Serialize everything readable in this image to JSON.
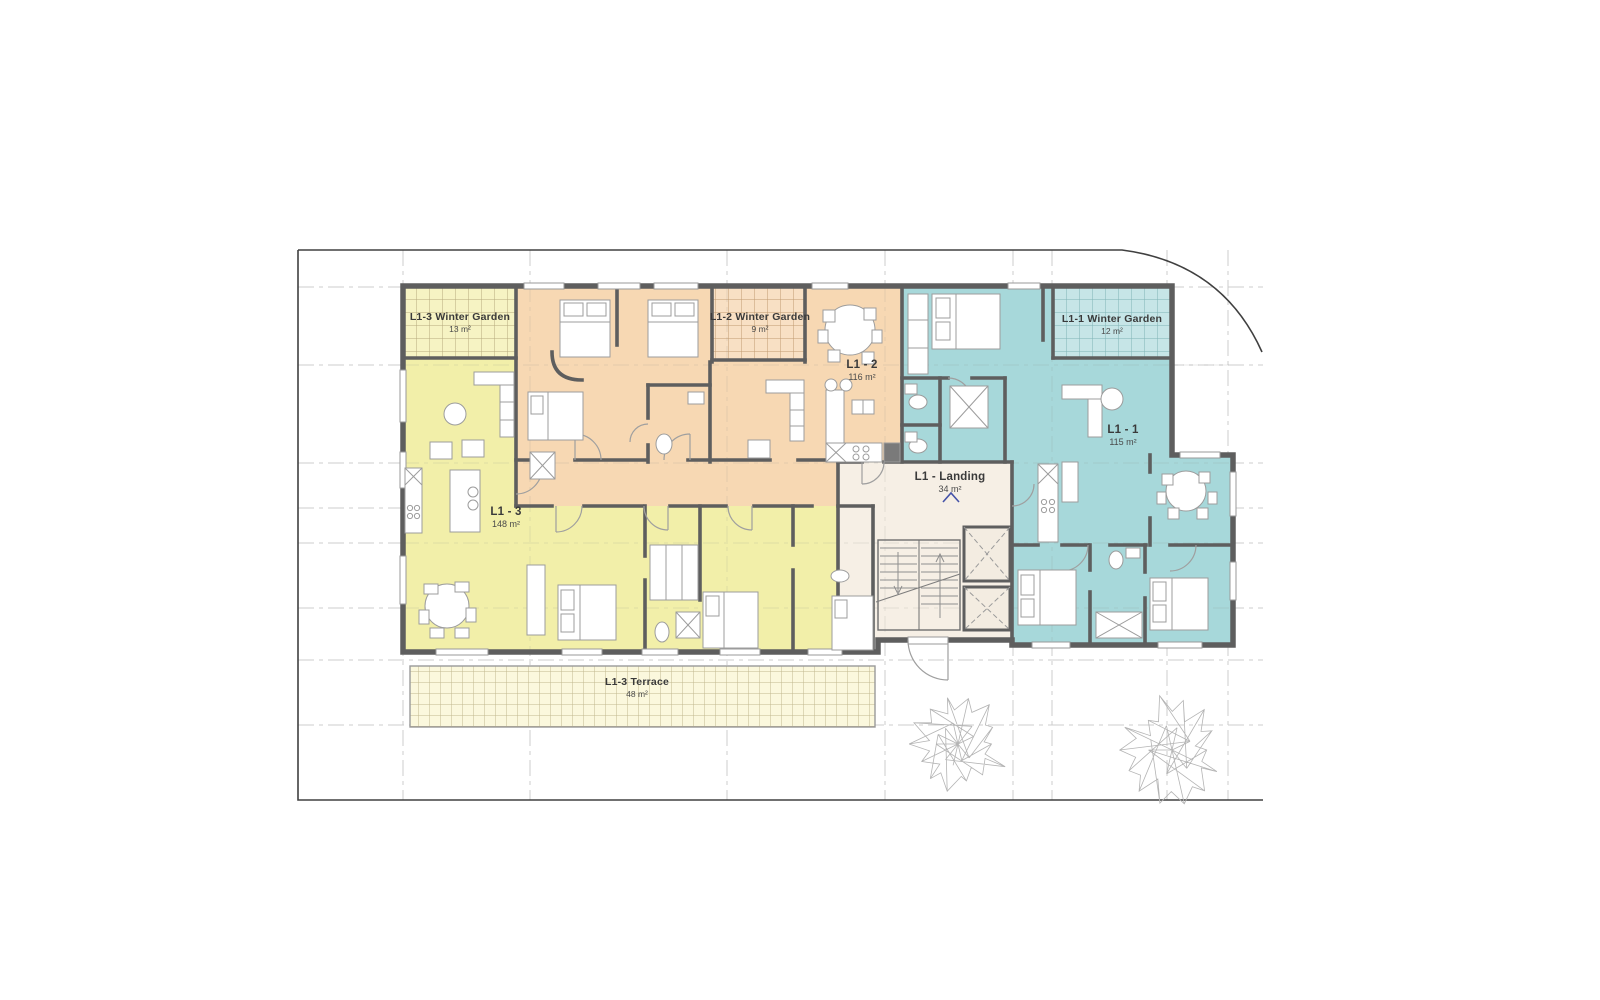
{
  "plan": {
    "units": [
      {
        "id": "l1-1",
        "label": "L1 - 1",
        "area": "115 m²",
        "color": "#a7d8da"
      },
      {
        "id": "l1-2",
        "label": "L1 - 2",
        "area": "116 m²",
        "color": "#f7d8b3"
      },
      {
        "id": "l1-3",
        "label": "L1 - 3",
        "area": "148 m²",
        "color": "#f2efa9"
      }
    ],
    "landing": {
      "label": "L1 - Landing",
      "area": "34 m²",
      "color": "#f6efe5"
    },
    "winter_gardens": [
      {
        "label": "L1-1 Winter Garden",
        "area": "12 m²",
        "color": "#c6e5e7"
      },
      {
        "label": "L1-2 Winter Garden",
        "area": "9 m²",
        "color": "#f8e0c4"
      },
      {
        "label": "L1-3 Winter Garden",
        "area": "13 m²",
        "color": "#f6f3c3"
      }
    ],
    "terrace": {
      "label": "L1-3 Terrace",
      "area": "48 m²",
      "color": "#fbf8dd"
    },
    "wall_color": "#5e5e5e",
    "boundary_color": "#404040"
  }
}
